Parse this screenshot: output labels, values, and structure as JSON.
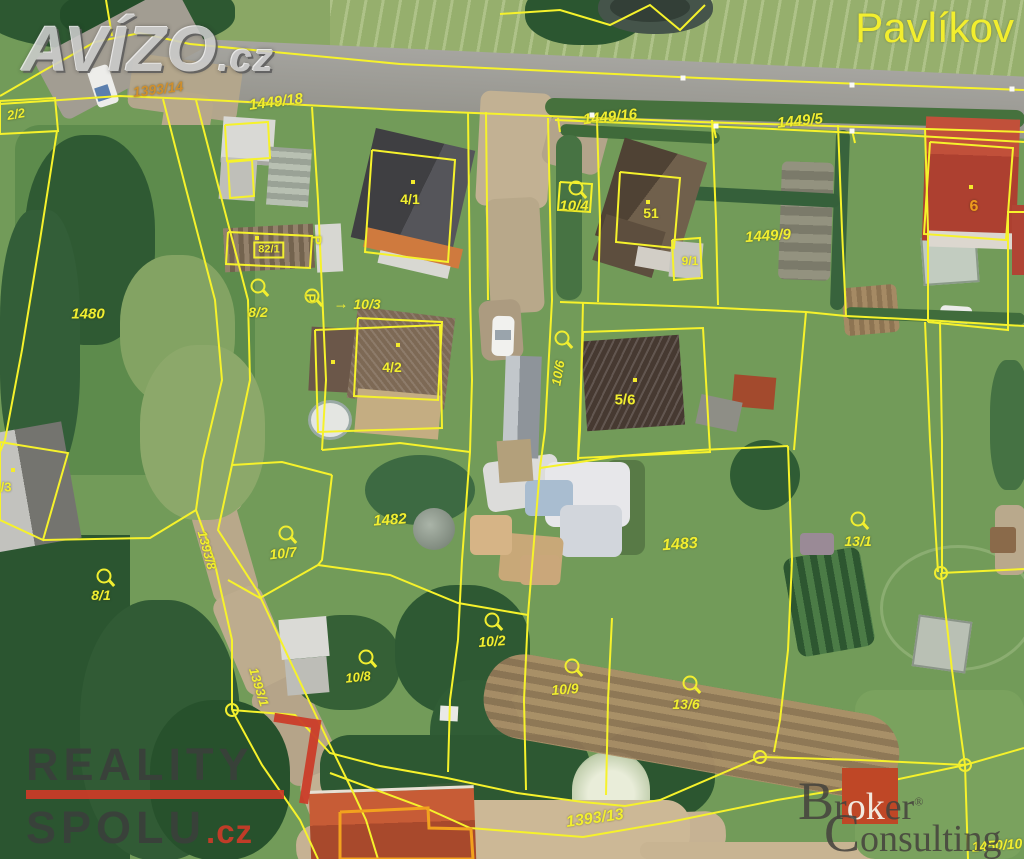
{
  "watermarks": {
    "avizo": {
      "name": "AVÍZO",
      "tld": ".cz"
    },
    "town_label": "Pavlíkov",
    "reality_spolu": {
      "line1": "REALITY",
      "line2": "SPOLU",
      "tld": ".cz"
    },
    "broker_consulting": {
      "word1_cap": "B",
      "word1_rest1": "r",
      "word1_mid": "ok",
      "word1_rest2": "er",
      "registered": "®",
      "word2_cap": "C",
      "word2_rest": "onsulting"
    }
  },
  "map": {
    "line_color": "#f6f22b",
    "label_color": "#f1ee30",
    "building_outline_color": "#f2a21e",
    "parcel_labels": [
      {
        "text": "1393/14",
        "x": 158,
        "y": 89,
        "rot": -7,
        "italic": true,
        "size": 14,
        "color": "#cf8f2e"
      },
      {
        "text": "1449/18",
        "x": 276,
        "y": 102,
        "rot": -7,
        "italic": true,
        "size": 15
      },
      {
        "text": "1449/16",
        "x": 610,
        "y": 117,
        "rot": -6,
        "italic": true,
        "size": 15
      },
      {
        "text": "1449/5",
        "x": 800,
        "y": 121,
        "rot": -6,
        "italic": true,
        "size": 15
      },
      {
        "text": "2/2",
        "x": 16,
        "y": 114,
        "rot": -10,
        "italic": true,
        "size": 13
      },
      {
        "text": "1480",
        "x": 88,
        "y": 314,
        "italic": true,
        "size": 15
      },
      {
        "text": "8/2",
        "x": 258,
        "y": 312,
        "italic": true,
        "size": 14
      },
      {
        "text": "82/1",
        "x": 269,
        "y": 250,
        "size": 11,
        "boxed": true
      },
      {
        "text": "4/1",
        "x": 410,
        "y": 199,
        "size": 14
      },
      {
        "text": "10/3",
        "x": 367,
        "y": 304,
        "italic": true,
        "size": 14
      },
      {
        "text": "10/4",
        "x": 574,
        "y": 206,
        "italic": true,
        "size": 15
      },
      {
        "text": "51",
        "x": 651,
        "y": 213,
        "size": 14
      },
      {
        "text": "9/1",
        "x": 690,
        "y": 261,
        "size": 12
      },
      {
        "text": "1449/9",
        "x": 768,
        "y": 236,
        "rot": -4,
        "italic": true,
        "size": 15
      },
      {
        "text": "6",
        "x": 974,
        "y": 207,
        "size": 16,
        "color": "#ee9b1d"
      },
      {
        "text": "4/2",
        "x": 392,
        "y": 367,
        "size": 14
      },
      {
        "text": "10/6",
        "x": 558,
        "y": 373,
        "rot": -80,
        "italic": true,
        "size": 13
      },
      {
        "text": "5/6",
        "x": 625,
        "y": 400,
        "size": 15
      },
      {
        "text": "/3",
        "x": 6,
        "y": 487,
        "size": 13
      },
      {
        "text": "8/1",
        "x": 101,
        "y": 595,
        "italic": true,
        "size": 14
      },
      {
        "text": "1393/8",
        "x": 207,
        "y": 550,
        "rot": 75,
        "italic": true,
        "size": 13
      },
      {
        "text": "1393/1",
        "x": 259,
        "y": 687,
        "rot": 73,
        "italic": true,
        "size": 13
      },
      {
        "text": "1482",
        "x": 390,
        "y": 520,
        "rot": -4,
        "italic": true,
        "size": 15
      },
      {
        "text": "10/7",
        "x": 283,
        "y": 553,
        "rot": -6,
        "italic": true,
        "size": 14
      },
      {
        "text": "1483",
        "x": 680,
        "y": 545,
        "rot": -4,
        "italic": true,
        "size": 16
      },
      {
        "text": "13/1",
        "x": 858,
        "y": 541,
        "italic": true,
        "size": 14
      },
      {
        "text": "10/2",
        "x": 492,
        "y": 641,
        "rot": -4,
        "italic": true,
        "size": 14
      },
      {
        "text": "10/8",
        "x": 358,
        "y": 677,
        "rot": -6,
        "italic": true,
        "size": 13
      },
      {
        "text": "10/9",
        "x": 565,
        "y": 689,
        "rot": -4,
        "italic": true,
        "size": 14
      },
      {
        "text": "13/6",
        "x": 686,
        "y": 704,
        "italic": true,
        "size": 14
      },
      {
        "text": "1393/13",
        "x": 595,
        "y": 819,
        "rot": -8,
        "italic": true,
        "size": 16
      },
      {
        "text": "1450/10",
        "x": 997,
        "y": 845,
        "rot": -4,
        "italic": true,
        "size": 14
      }
    ],
    "circle_symbols": [
      {
        "x": 576,
        "y": 188
      },
      {
        "x": 312,
        "y": 296
      },
      {
        "x": 258,
        "y": 286
      },
      {
        "x": 562,
        "y": 338
      },
      {
        "x": 286,
        "y": 533
      },
      {
        "x": 104,
        "y": 576
      },
      {
        "x": 492,
        "y": 620
      },
      {
        "x": 366,
        "y": 657
      },
      {
        "x": 572,
        "y": 666
      },
      {
        "x": 690,
        "y": 683
      },
      {
        "x": 858,
        "y": 519
      }
    ],
    "flag_symbols": [
      {
        "x": 317,
        "y": 240
      },
      {
        "x": 311,
        "y": 298
      }
    ],
    "arrows": [
      {
        "x": 341,
        "y": 304,
        "glyph": "→"
      }
    ],
    "yellow_dots": [
      {
        "x": 413,
        "y": 182
      },
      {
        "x": 398,
        "y": 345
      },
      {
        "x": 333,
        "y": 362
      },
      {
        "x": 635,
        "y": 380
      },
      {
        "x": 971,
        "y": 187
      },
      {
        "x": 648,
        "y": 202
      },
      {
        "x": 257,
        "y": 238
      },
      {
        "x": 13,
        "y": 470
      }
    ],
    "white_dots": [
      {
        "x": 683,
        "y": 78
      },
      {
        "x": 852,
        "y": 85
      },
      {
        "x": 1012,
        "y": 89
      },
      {
        "x": 592,
        "y": 115
      },
      {
        "x": 716,
        "y": 126
      },
      {
        "x": 852,
        "y": 131
      }
    ],
    "junction_nodes": [
      {
        "x": 232,
        "y": 710
      },
      {
        "x": 760,
        "y": 757
      },
      {
        "x": 965,
        "y": 765
      },
      {
        "x": 941,
        "y": 573
      }
    ],
    "boundaries": [
      {
        "points": "0,96 45,70 95,42 140,33 190,44"
      },
      {
        "points": "112,36 106,0"
      },
      {
        "points": "190,44 400,64 700,78 1024,90"
      },
      {
        "points": "0,104 120,96 190,99 400,110 700,122 1024,132"
      },
      {
        "points": "555,120 750,128 900,135 1024,142"
      },
      {
        "points": "0,101 55,98 58,131 0,134 0,101"
      },
      {
        "points": "57,131 40,240 22,350 5,440 0,452"
      },
      {
        "points": "163,99 185,185 215,300 222,380 203,460 196,510 214,560 232,640 232,710"
      },
      {
        "points": "196,100 218,185 248,300 250,380 232,465 218,530 258,592 292,665 330,745 352,790 366,820 378,859"
      },
      {
        "points": "312,107 318,200 322,290 326,380 322,450"
      },
      {
        "points": "468,112 470,290 472,380 470,452 462,560 458,640"
      },
      {
        "points": "486,112 488,300"
      },
      {
        "points": "548,118 552,300 545,430 540,468 528,615"
      },
      {
        "points": "583,302 580,430 578,460"
      },
      {
        "points": "597,120 600,220 598,302"
      },
      {
        "points": "712,120 716,220 718,305"
      },
      {
        "points": "838,125 842,230 846,316"
      },
      {
        "points": "925,128 928,230 928,322"
      },
      {
        "points": "560,302 700,307 806,312 846,316 925,320 1024,326"
      },
      {
        "points": "583,332 703,328 710,452 578,458 583,332"
      },
      {
        "points": "672,240 700,238 702,278 674,280 672,240"
      },
      {
        "points": "232,465 282,462 332,475"
      },
      {
        "points": "332,475 322,560 318,565"
      },
      {
        "points": "318,565 260,598 228,580"
      },
      {
        "points": "318,565 390,575 458,603 528,615"
      },
      {
        "points": "322,450 400,443 470,452"
      },
      {
        "points": "540,468 620,456 700,450 788,446"
      },
      {
        "points": "788,446 792,560 788,650 780,720 774,752"
      },
      {
        "points": "806,312 800,380 794,450"
      },
      {
        "points": "925,322 930,440 938,572"
      },
      {
        "points": "940,322 942,440 942,572"
      },
      {
        "points": "941,573 1024,569"
      },
      {
        "points": "941,573 952,670 965,765"
      },
      {
        "points": "232,710 295,715 330,753 380,766 447,778 517,793 583,802 625,806 660,800 760,757 860,760 965,765"
      },
      {
        "points": "330,773 430,810 470,828 583,837 670,822 777,800 880,783 965,765"
      },
      {
        "points": "965,765 968,859"
      },
      {
        "points": "1024,748 965,765"
      },
      {
        "points": "1024,212 1008,212 1008,330 928,322"
      },
      {
        "points": "0,442 68,453 43,540 0,520 0,442"
      },
      {
        "points": "43,540 150,538 196,510"
      },
      {
        "points": "500,14 560,10 610,25 650,5 680,30 705,5"
      },
      {
        "points": "372,150 455,160 448,262 365,252 372,150"
      },
      {
        "points": "315,330 440,325 442,428 318,432 315,330"
      },
      {
        "points": "358,318 442,322 438,400 354,396 358,318"
      },
      {
        "points": "228,232 312,236 310,268 226,264 228,232"
      },
      {
        "points": "620,172 680,178 674,248 616,242 620,172"
      },
      {
        "points": "930,142 1013,148 1006,240 924,234 930,142"
      },
      {
        "points": "225,125 268,122 270,158 227,161 225,125"
      },
      {
        "points": "228,162 252,160 254,196 230,198 228,162"
      },
      {
        "points": "560,182 592,184 590,212 558,210 560,182"
      },
      {
        "points": "458,640 450,700 448,772"
      },
      {
        "points": "528,615 524,700 526,790"
      },
      {
        "points": "612,618 608,700 606,795"
      },
      {
        "points": "558,118 560,132"
      },
      {
        "points": "713,124 716,138"
      },
      {
        "points": "852,130 855,143"
      },
      {
        "points": "232,710 262,765 300,820 318,859"
      },
      {
        "points": "340,812 428,808 429,828 471,829 473,859 340,859 340,812",
        "color": "#f2a21e",
        "width": 3
      }
    ]
  }
}
